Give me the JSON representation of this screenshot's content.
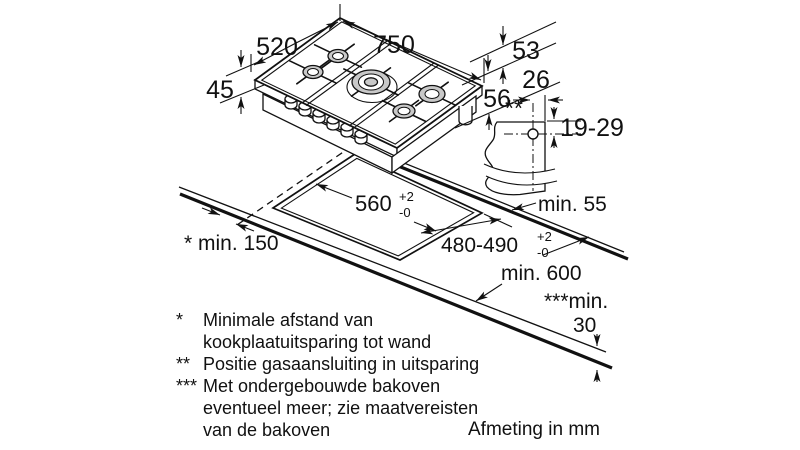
{
  "title": "Gas hob installation drawing",
  "colors": {
    "line": "#111111",
    "burner_fill": "#c8c8c8",
    "background": "#ffffff"
  },
  "drawing": {
    "dims": {
      "hob_width": "750",
      "hob_depth": "520",
      "edge_height": "53",
      "tray_height": "45",
      "build_in_height": "56",
      "gas_offset": "26",
      "gas_marker": "**",
      "gas_height_range": "19-29",
      "min_back": "min. 55",
      "cutout_width": "560",
      "cutout_depth": "480-490",
      "tol_plus": "+2",
      "tol_minus": "-0",
      "min_side": "* min. 150",
      "min_counter_depth": "min. 600",
      "min_thickness_label": "***min.",
      "min_thickness_value": "30"
    },
    "footnotes": [
      {
        "marker": "*",
        "lines": [
          "Minimale afstand van",
          "kookplaatuitsparing tot wand"
        ]
      },
      {
        "marker": "**",
        "lines": [
          "Positie gasaansluiting in uitsparing"
        ]
      },
      {
        "marker": "***",
        "lines": [
          "Met ondergebouwde bakoven",
          "eventueel meer; zie maatvereisten",
          "van de bakoven"
        ]
      }
    ],
    "caption": "Afmeting in mm"
  }
}
